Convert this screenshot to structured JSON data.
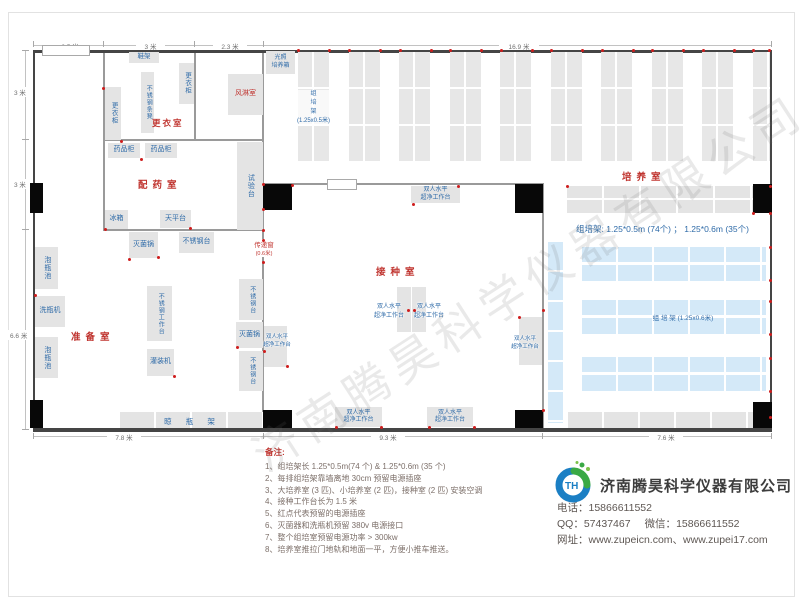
{
  "watermark": "济南腾昊科学仪器有限公司",
  "dims": {
    "top": [
      "2.5 米",
      "3 米",
      "2.3 米",
      "16.9 米"
    ],
    "left": [
      "3 米",
      "3 米",
      "6.6 米"
    ],
    "bottom": [
      "7.8 米",
      "9.3 米",
      "7.6 米"
    ]
  },
  "rooms": {
    "changing_room": "更衣室",
    "air_shower": "风淋室",
    "dispensing_room": "配药室",
    "prep_room": "准备室",
    "inoculation_room": "接种室",
    "culture_room": "培养室"
  },
  "equipment": {
    "shoe_rack": "鞋架",
    "locker": "更衣柜",
    "ss_bench_seat": "不锈钢条凳",
    "light_incubator": "光照\n培养箱",
    "medicine_cabinet": "药品柜",
    "test_bench": "试验台",
    "fridge": "冰箱",
    "balance_table": "天平台",
    "sterilizer": "灭菌锅",
    "ss_table": "不锈钢台",
    "ss_worktable": "不锈钢工作台",
    "bottle_soak_pool": "泡瓶池",
    "bottle_washer": "洗瓶机",
    "filling_machine": "灌装机",
    "bottle_dry_rack": "晾 瓶 架",
    "pass_window": "传递窗",
    "pass_window_size": "(0.6米)",
    "clean_bench": "双人水平\n超净工作台",
    "rack_label_vertical": "组\n培\n架\n(1.25x0.5米)",
    "rack_label_horizontal": "组 培 架 (1.25x0.6米)",
    "rack_summary": "组培架: 1.25*0.5m (74个) ； 1.25*0.6m (35个)"
  },
  "notes": {
    "title": "备注:",
    "items": [
      "1、组培架长 1.25*0.5m(74 个) & 1.25*0.6m (35 个)",
      "2、每排组培架靠墙离地 30cm 预留电源插座",
      "3、大培养室 (3 匹)、小培养室 (2 匹)，接种室 (2 匹) 安装空调",
      "4、接种工作台长为 1.5 米",
      "5、红点代表预留的电源插座",
      "6、灭菌器和洗瓶机预留 380v 电源接口",
      "7、整个组培室预留电源功率 > 300kw",
      "8、培养室推拉门地轨和地面一平，方便小推车推送。"
    ]
  },
  "company": {
    "name": "济南腾昊科学仪器有限公司",
    "logo_text": "TH",
    "phone_label": "电话：",
    "phone": "15866611552",
    "qq_label": "QQ：",
    "qq": "57437467",
    "wechat_label": "微信：",
    "wechat": "15866611552",
    "web_label": "网址：",
    "websites": "www.zupeicn.com、www.zupei17.com"
  },
  "colors": {
    "room_label": "#c03530",
    "equipment_text": "#2f6ba8",
    "outlet_dot": "#ce1d1d",
    "blue_rack": "#d4e9f8",
    "logo_blue": "#1b7fc4",
    "logo_green": "#3aa945"
  }
}
